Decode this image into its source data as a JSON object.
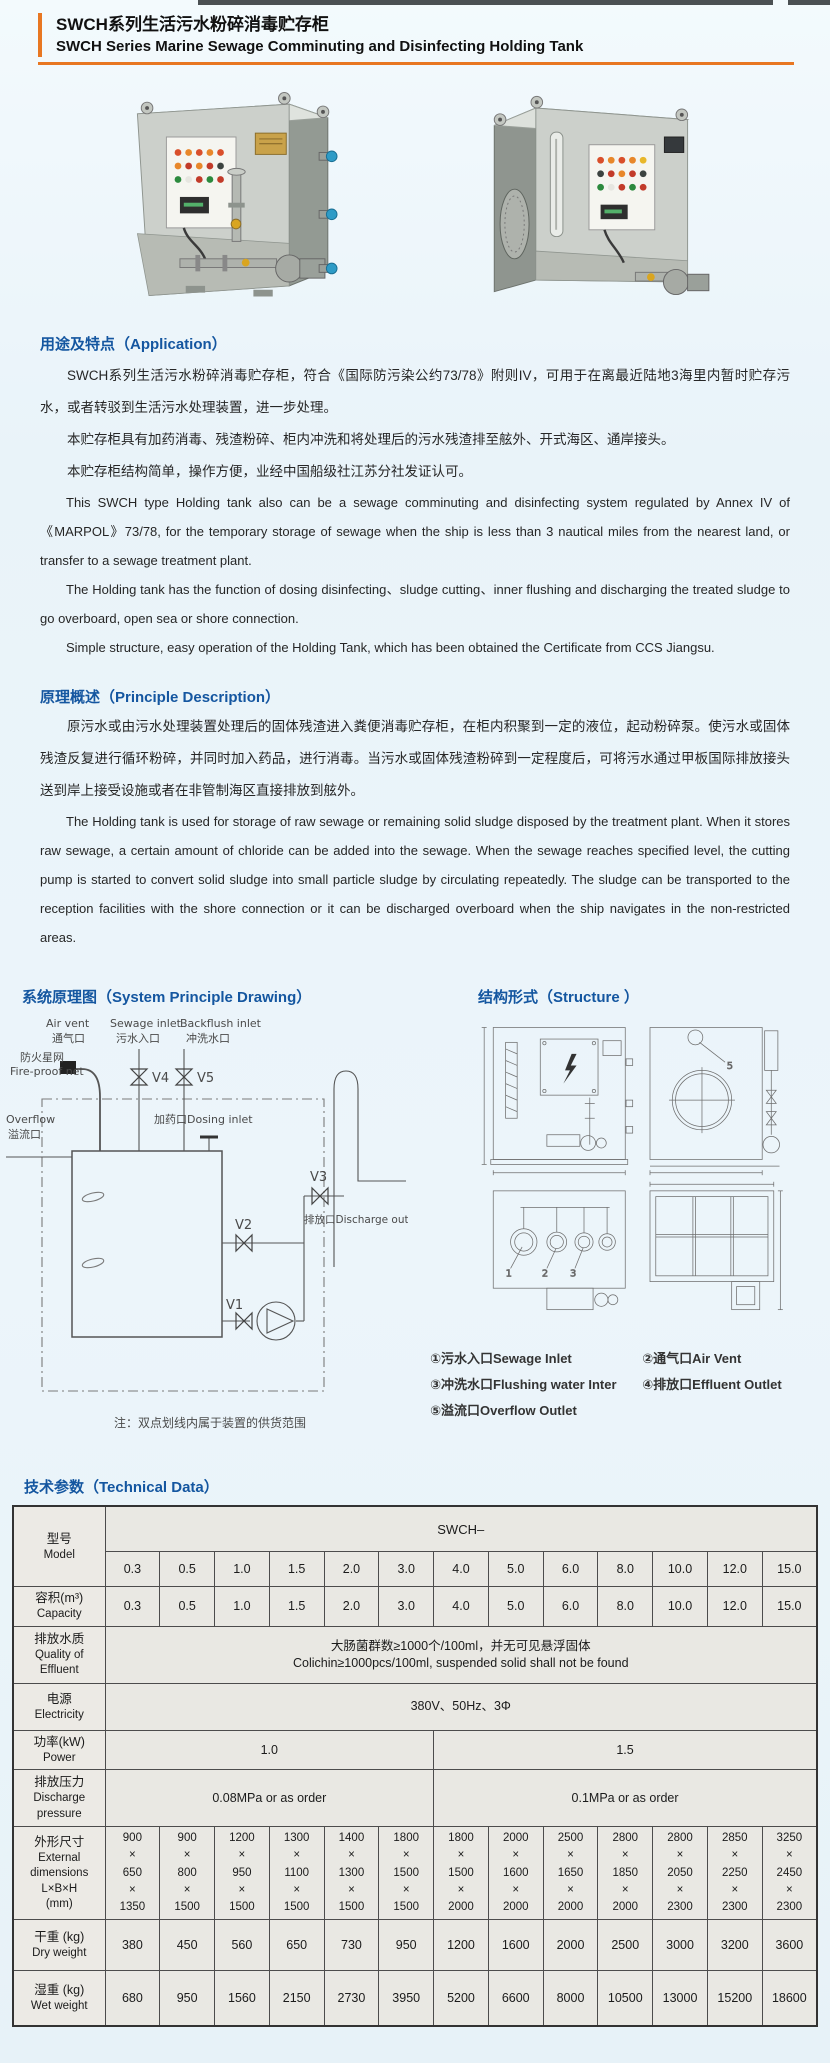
{
  "colors": {
    "accent_orange": "#e87722",
    "heading_blue": "#1456a0",
    "table_bg": "#e9e8e3"
  },
  "header": {
    "title_zh": "SWCH系列生活污水粉碎消毒贮存柜",
    "title_en": "SWCH Series Marine Sewage Comminuting and Disinfecting Holding Tank"
  },
  "sections": {
    "application": {
      "heading": "用途及特点（Application）",
      "paragraphs_zh": [
        "SWCH系列生活污水粉碎消毒贮存柜，符合《国际防污染公约73/78》附则IV，可用于在离最近陆地3海里内暂时贮存污水，或者转驳到生活污水处理装置，进一步处理。",
        "本贮存柜具有加药消毒、残渣粉碎、柜内冲洗和将处理后的污水残渣排至舷外、开式海区、通岸接头。",
        "本贮存柜结构简单，操作方便，业经中国船级社江苏分社发证认可。"
      ],
      "paragraphs_en": [
        "This SWCH type Holding tank also can be a sewage comminuting and disinfecting system regulated by Annex IV of 《MARPOL》73/78, for the temporary storage of sewage when the ship is less than 3 nautical miles from the nearest land, or transfer to a sewage treatment plant.",
        "The Holding tank has the function of dosing disinfecting、sludge cutting、inner flushing and discharging the treated sludge to go overboard, open sea or shore connection.",
        "Simple structure, easy operation of the Holding Tank, which has been obtained the Certificate from CCS Jiangsu."
      ]
    },
    "principle": {
      "heading": "原理概述（Principle Description）",
      "paragraph_zh": "原污水或由污水处理装置处理后的固体残渣进入粪便消毒贮存柜，在柜内积聚到一定的液位，起动粉碎泵。使污水或固体残渣反复进行循环粉碎，并同时加入药品，进行消毒。当污水或固体残渣粉碎到一定程度后，可将污水通过甲板国际排放接头送到岸上接受设施或者在非管制海区直接排放到舷外。",
      "paragraph_en": "The Holding tank is used for storage of raw sewage or remaining solid sludge disposed by the treatment plant. When it stores raw sewage, a certain amount of chloride can be added into the sewage. When the sewage reaches specified level, the cutting pump is started to convert solid sludge into small particle sludge by circulating repeatedly. The sludge can be transported to the reception facilities with the shore connection or it can be discharged overboard when the ship navigates in the non-restricted areas."
    },
    "principle_drawing": {
      "heading": "系统原理图（System Principle Drawing）",
      "labels": {
        "air_vent_en": "Air vent",
        "air_vent_zh": "通气口",
        "sewage_en": "Sewage inlet",
        "sewage_zh": "污水入口",
        "backflush_en": "Backflush inlet",
        "backflush_zh": "冲洗水口",
        "fireproof_zh": "防火星网",
        "fireproof_en": "Fire-proof net",
        "overflow_en": "Overflow",
        "overflow_zh": "溢流口",
        "dosing": "加药口Dosing inlet",
        "discharge": "排放口Discharge outlet",
        "v1": "V1",
        "v2": "V2",
        "v3": "V3",
        "v4": "V4",
        "v5": "V5"
      },
      "note": "注：双点划线内属于装置的供货范围"
    },
    "structure": {
      "heading": "结构形式（Structure ）",
      "legend": [
        "①污水入口Sewage Inlet",
        "②通气口Air Vent",
        "③冲洗水口Flushing water Inter",
        "④排放口Effluent Outlet",
        "⑤溢流口Overflow Outlet"
      ]
    },
    "technical": {
      "heading": "技术参数（Technical Data）",
      "table": {
        "model": {
          "label_zh": "型号",
          "label_en": "Model",
          "series": "SWCH–",
          "models": [
            "0.3",
            "0.5",
            "1.0",
            "1.5",
            "2.0",
            "3.0",
            "4.0",
            "5.0",
            "6.0",
            "8.0",
            "10.0",
            "12.0",
            "15.0"
          ]
        },
        "capacity": {
          "label_zh": "容积(m³)",
          "label_en": "Capacity",
          "values": [
            "0.3",
            "0.5",
            "1.0",
            "1.5",
            "2.0",
            "3.0",
            "4.0",
            "5.0",
            "6.0",
            "8.0",
            "10.0",
            "12.0",
            "15.0"
          ]
        },
        "effluent": {
          "label_zh": "排放水质",
          "label_en": "Quality of Effluent",
          "value_zh": "大肠菌群数≥1000个/100ml，并无可见悬浮固体",
          "value_en": "Colichin≥1000pcs/100ml, suspended solid shall not be found"
        },
        "electricity": {
          "label_zh": "电源",
          "label_en": "Electricity",
          "value": "380V、50Hz、3Φ"
        },
        "power": {
          "label_zh": "功率(kW)",
          "label_en": "Power",
          "values": [
            {
              "text": "1.0",
              "span": 6
            },
            {
              "text": "1.5",
              "span": 7
            }
          ]
        },
        "pressure": {
          "label_zh": "排放压力",
          "label_en": "Discharge pressure",
          "values": [
            {
              "text": "0.08MPa or as order",
              "span": 6
            },
            {
              "text": "0.1MPa or as order",
              "span": 7
            }
          ]
        },
        "dimensions": {
          "label_lines": [
            "外形尺寸",
            "External",
            "dimensions",
            "L×B×H",
            "(mm)"
          ],
          "values": [
            [
              900,
              650,
              1350
            ],
            [
              900,
              800,
              1500
            ],
            [
              1200,
              950,
              1500
            ],
            [
              1300,
              1100,
              1500
            ],
            [
              1400,
              1300,
              1500
            ],
            [
              1800,
              1500,
              1500
            ],
            [
              1800,
              1500,
              2000
            ],
            [
              2000,
              1600,
              2000
            ],
            [
              2500,
              1650,
              2000
            ],
            [
              2800,
              1850,
              2000
            ],
            [
              2800,
              2050,
              2300
            ],
            [
              2850,
              2250,
              2300
            ],
            [
              3250,
              2450,
              2300
            ]
          ]
        },
        "dry_weight": {
          "label_zh": "干重 (kg)",
          "label_en": "Dry weight",
          "values": [
            380,
            450,
            560,
            650,
            730,
            950,
            1200,
            1600,
            2000,
            2500,
            3000,
            3200,
            3600
          ]
        },
        "wet_weight": {
          "label_zh": "湿重 (kg)",
          "label_en": "Wet weight",
          "values": [
            680,
            950,
            1560,
            2150,
            2730,
            3950,
            5200,
            6600,
            8000,
            10500,
            13000,
            15200,
            18600
          ]
        }
      }
    }
  }
}
